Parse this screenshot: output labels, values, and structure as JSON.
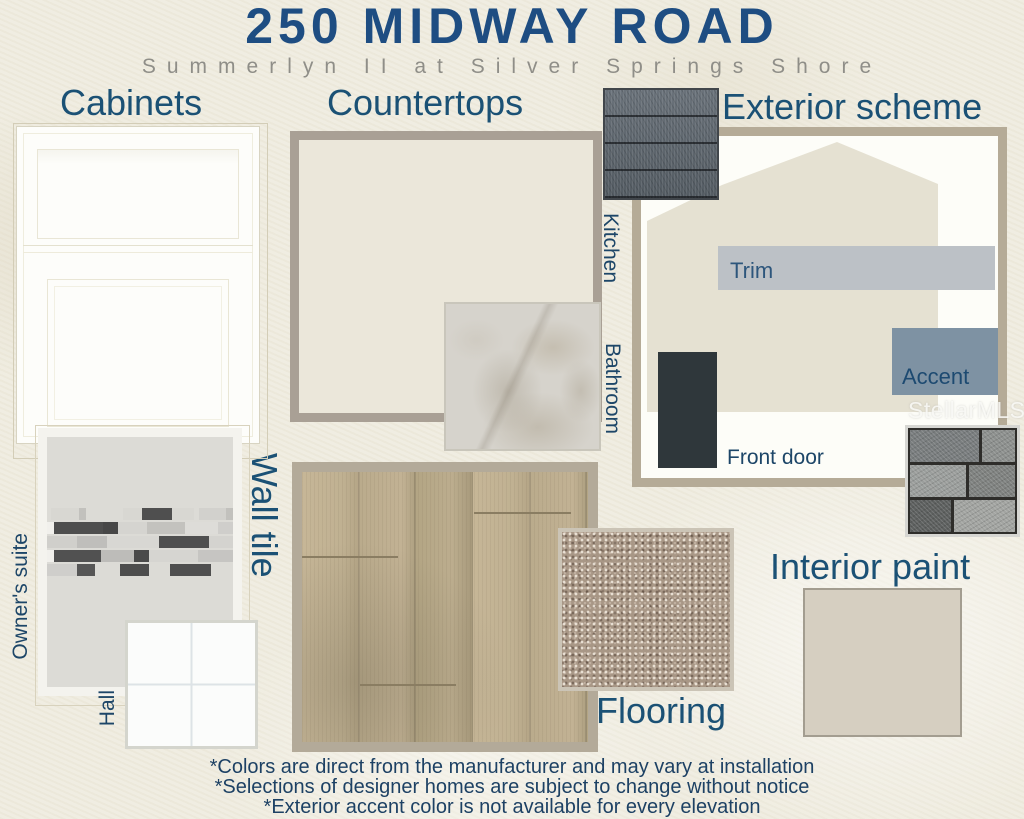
{
  "board": {
    "title": "250 MIDWAY ROAD",
    "subtitle": "Summerlyn II at Silver Springs Shore",
    "watermark": "StellarMLS"
  },
  "sections": {
    "cabinets": {
      "label": "Cabinets"
    },
    "countertops": {
      "label": "Countertops",
      "kitchen_label": "Kitchen",
      "bathroom_label": "Bathroom"
    },
    "exterior": {
      "label": "Exterior scheme",
      "trim_label": "Trim",
      "accent_label": "Accent",
      "front_door_label": "Front door"
    },
    "wall_tile": {
      "label": "Wall tile",
      "owners_suite_label": "Owner's suite",
      "hall_label": "Hall"
    },
    "flooring": {
      "label": "Flooring"
    },
    "interior_paint": {
      "label": "Interior paint"
    }
  },
  "footnotes": [
    "*Colors are direct from the manufacturer and may vary at installation",
    "*Selections of designer homes are subject to change without notice",
    "*Exterior accent color is not available for every elevation"
  ],
  "colors": {
    "title_blue": "#1e4d82",
    "heading_blue": "#1b5175",
    "label_navy": "#1d4668",
    "house_body": "#e5e1d2",
    "trim": "#bcc1c6",
    "accent": "#7e92a3",
    "front_door": "#2f373b",
    "interior_paint": "#d6cfc1",
    "kitchen_countertop": "#ebe7da",
    "owners_suite_tile": "#dcdbd6",
    "hall_tile": "#fbfcfb"
  }
}
